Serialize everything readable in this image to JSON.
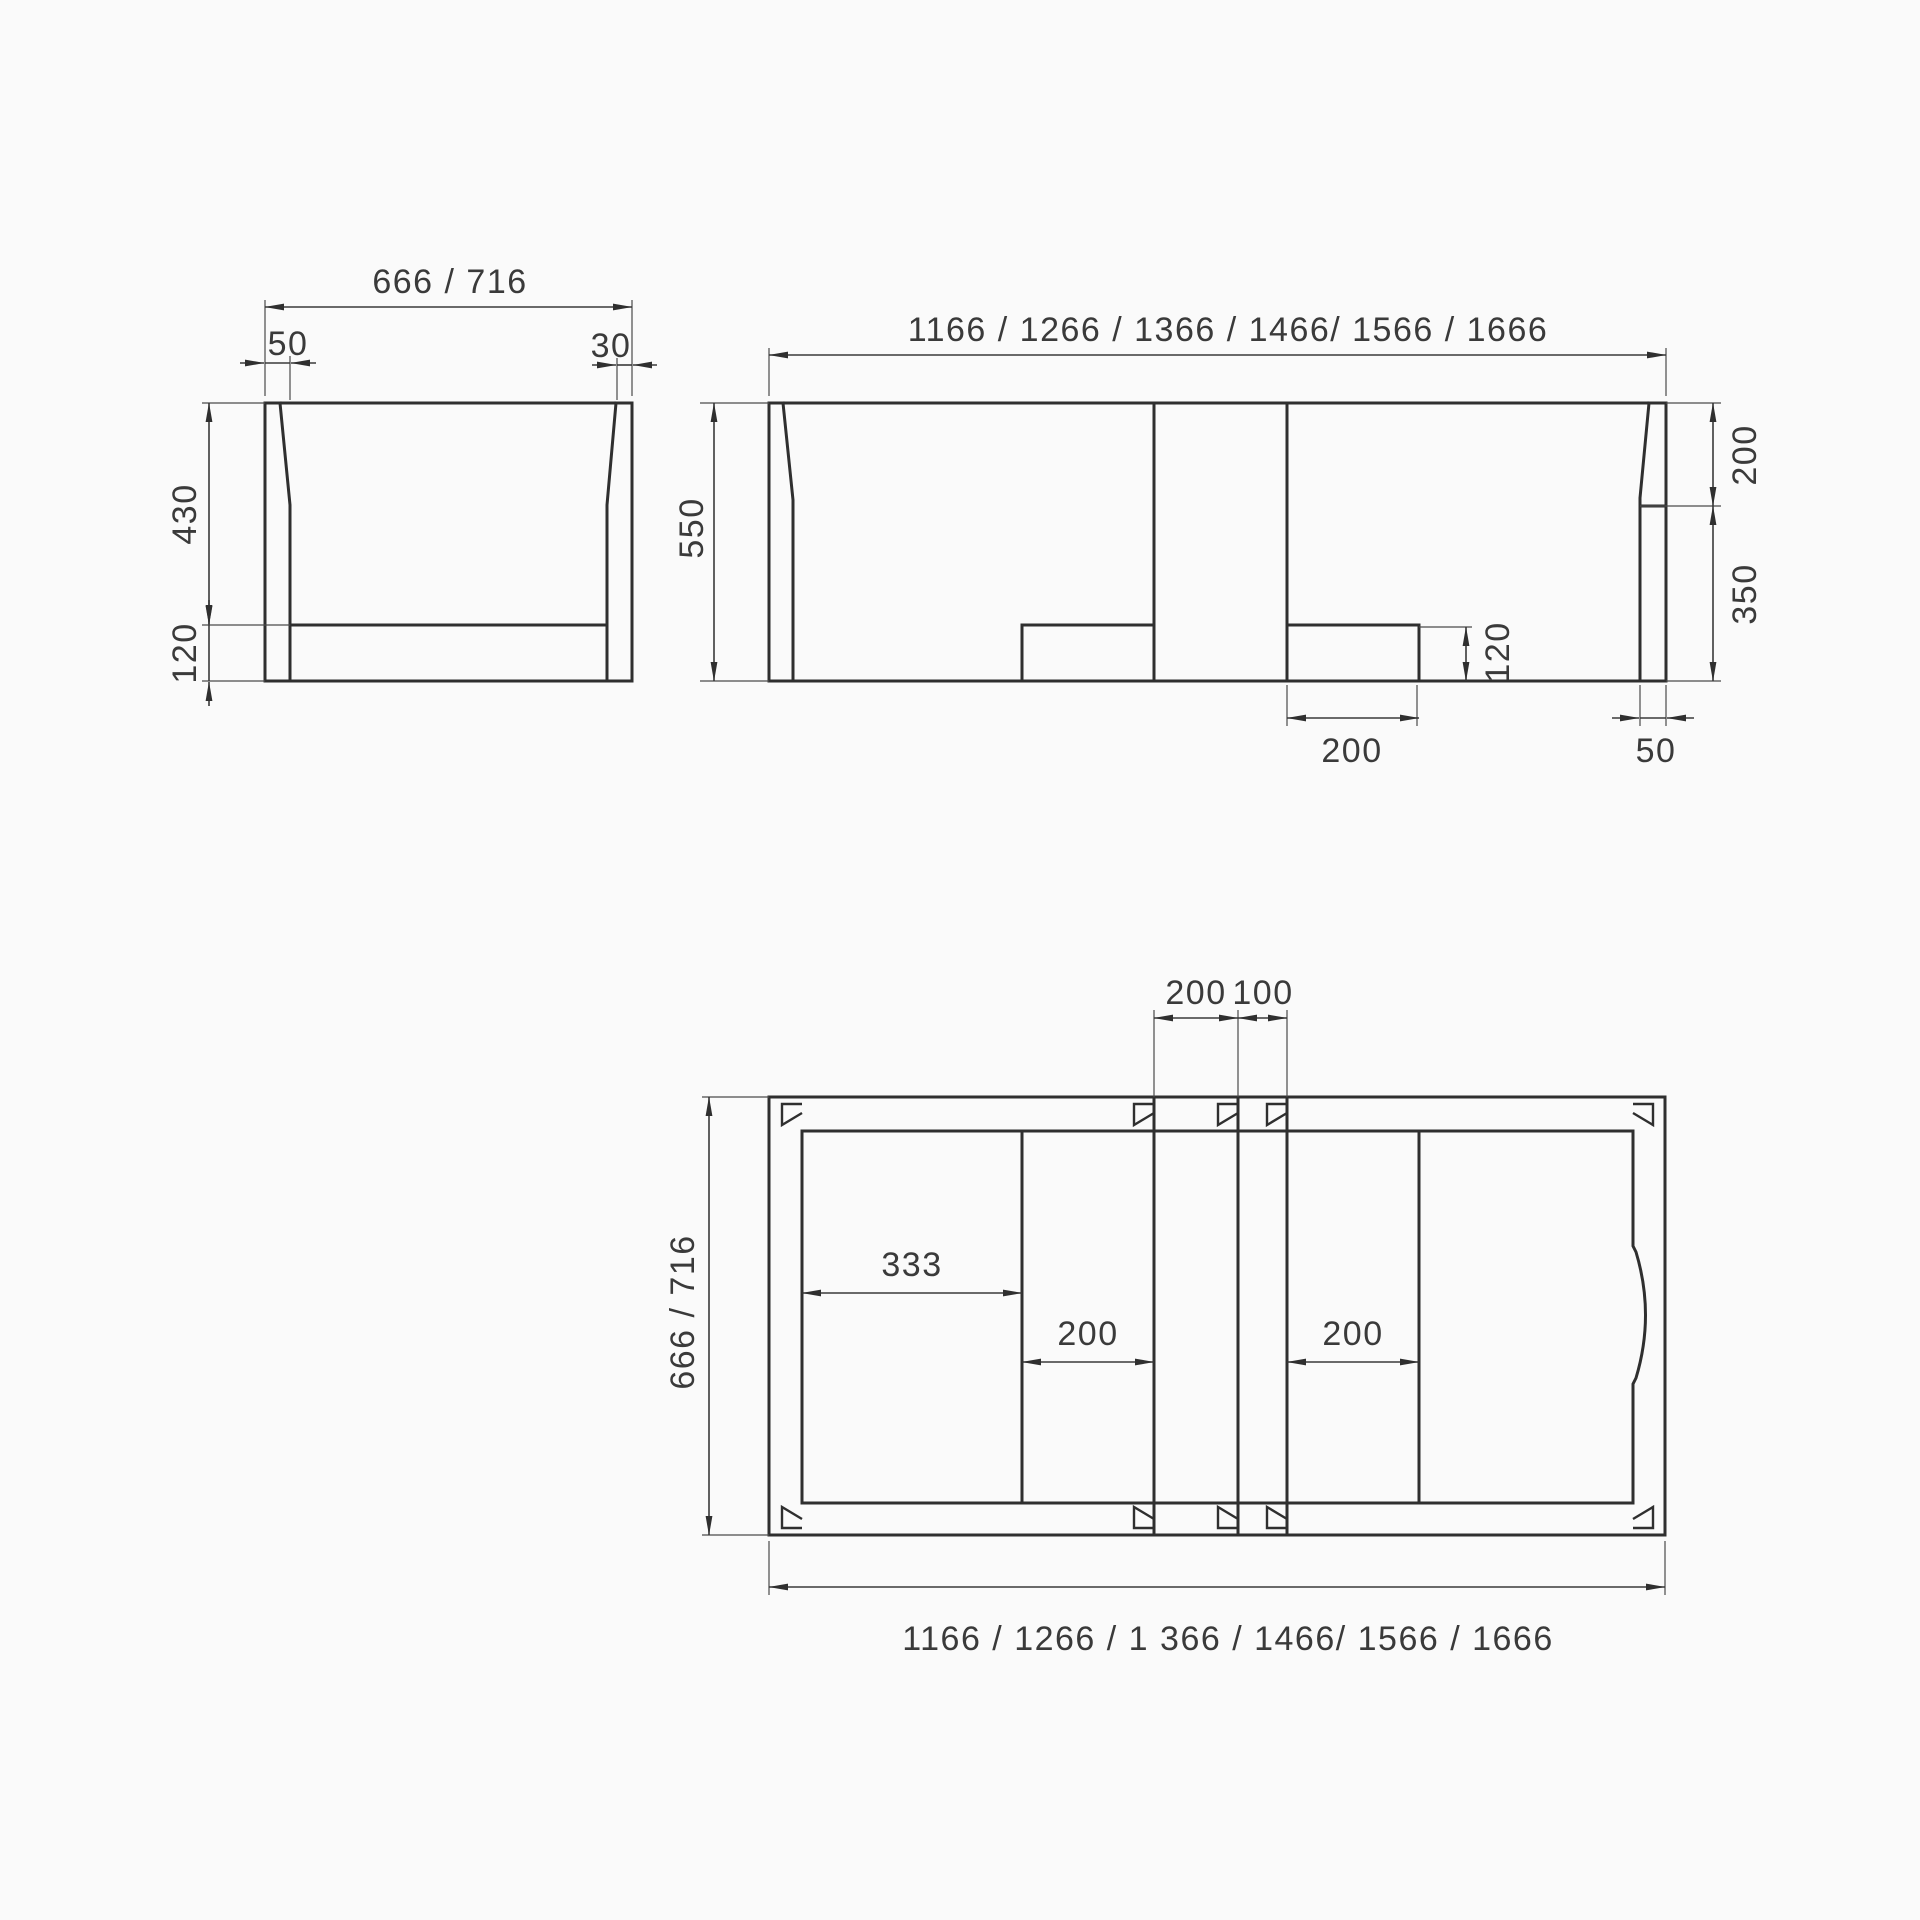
{
  "colors": {
    "background": "#fafafa",
    "object_line": "#2f2f2f",
    "dimension_line": "#3a3a3a",
    "text": "#3a3a3a"
  },
  "side_view": {
    "width_label": "666 / 716",
    "wall_left_label": "50",
    "wall_right_label": "30",
    "upper_height_label": "430",
    "lower_height_label": "120"
  },
  "front_view": {
    "width_label": "1166 / 1266 / 1366 / 1466/ 1566 / 1666",
    "height_label": "550",
    "right_upper_label": "200",
    "right_lower_label": "350",
    "step_height_label": "120",
    "step_width_label": "200",
    "wall_label": "50"
  },
  "plan_view": {
    "gap_left_label": "200",
    "gap_right_label": "100",
    "offset_label": "333",
    "left_seat_label": "200",
    "right_seat_label": "200",
    "depth_label": "666 / 716",
    "width_label": "1166 / 1266 / 1 366 / 1466/ 1566 / 1666"
  }
}
